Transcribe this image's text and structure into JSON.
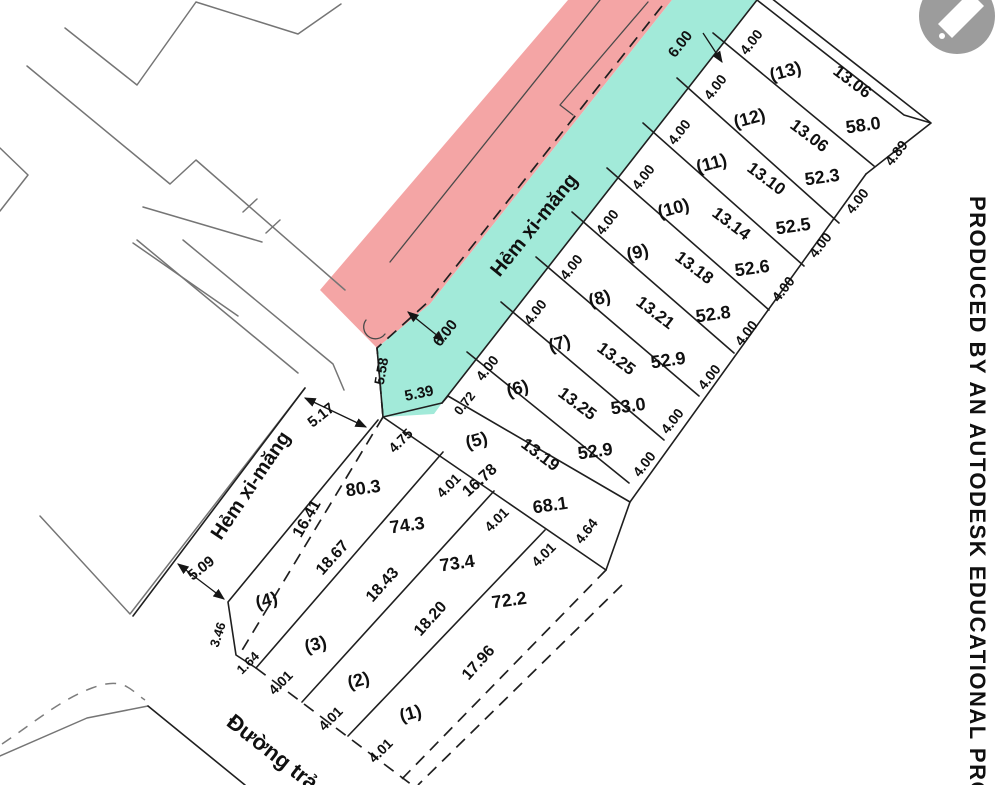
{
  "document": {
    "type": "cadastral subdivision site plan",
    "watermark_text": "PRODUCED BY AN AUTODESK EDUCATIONAL PRO",
    "overlay_icon": "pen-icon"
  },
  "colors": {
    "highlight_pink": "#f4a5a5",
    "highlight_cyan": "#a2ead9",
    "main_line": "#1f1f1f",
    "neighbor_line": "#757575",
    "watermark_circle": "#9c9c9c"
  },
  "streets": {
    "alley_upper": "Hẻm xi-măng",
    "alley_lower": "Hẻm xi-măng",
    "road_bottom": "Đường trả",
    "alley_width_top": "6.00",
    "alley_width_mid": "6.00",
    "alley_lower_widths": [
      "5.17",
      "5.09"
    ]
  },
  "plots_upper": [
    {
      "id": "(13)",
      "frontage": "4.00",
      "length": "13.06",
      "area": "58.0",
      "rear_edge": "4.89"
    },
    {
      "id": "(12)",
      "frontage": "4.00",
      "length": "13.06",
      "area": "52.3"
    },
    {
      "id": "(11)",
      "frontage": "4.00",
      "length": "13.10",
      "area": "52.5"
    },
    {
      "id": "(10)",
      "frontage": "4.00",
      "length": "13.14",
      "area": "52.6"
    },
    {
      "id": "(9)",
      "frontage": "4.00",
      "length": "13.18",
      "area": "52.8"
    },
    {
      "id": "(8)",
      "frontage": "4.00",
      "length": "13.21",
      "area": "52.9"
    },
    {
      "id": "(7)",
      "frontage": "4.00",
      "length": "13.25",
      "area": "53.0"
    },
    {
      "id": "(6)",
      "frontage": "4.00",
      "length": "13.25",
      "area": "52.9"
    },
    {
      "id": "(5)",
      "frontage": "4.00",
      "length": "13.19",
      "area": ""
    }
  ],
  "transition_strip": {
    "length": "16.78",
    "area": "68.1",
    "end_widths": [
      "4.01",
      "4.64"
    ],
    "jog": "0.72"
  },
  "plots_lower": [
    {
      "id": "(4)",
      "nw_edge": "16.41",
      "se_edge": "18.67",
      "area": "80.3",
      "top_width": "4.75",
      "west_edges": [
        "3.46",
        "1.64"
      ]
    },
    {
      "id": "(3)",
      "nw_edge": "18.67",
      "se_edge": "18.43",
      "area": "74.3",
      "top_width": "4.01",
      "road_width": "4.01"
    },
    {
      "id": "(2)",
      "nw_edge": "18.43",
      "se_edge": "18.20",
      "area": "73.4",
      "top_width": "4.01",
      "road_width": "4.01"
    },
    {
      "id": "(1)",
      "nw_edge": "18.20",
      "se_edge": "17.96",
      "area": "72.2",
      "top_width": "4.01",
      "road_width": "4.01"
    }
  ],
  "junction_dims": [
    "5.58",
    "5.39",
    "0.72",
    "5.17",
    "4.75"
  ],
  "labels": [
    {
      "t": "(13)",
      "x": 787,
      "y": 77,
      "r": -15,
      "s": 18,
      "n": "plot-number"
    },
    {
      "t": "(12)",
      "x": 751,
      "y": 124,
      "r": -15,
      "s": 18,
      "n": "plot-number"
    },
    {
      "t": "(11)",
      "x": 713,
      "y": 169,
      "r": -15,
      "s": 18,
      "n": "plot-number"
    },
    {
      "t": "(10)",
      "x": 675,
      "y": 214,
      "r": -15,
      "s": 18,
      "n": "plot-number"
    },
    {
      "t": "(9)",
      "x": 639,
      "y": 258,
      "r": -15,
      "s": 18,
      "n": "plot-number"
    },
    {
      "t": "(8)",
      "x": 601,
      "y": 304,
      "r": -15,
      "s": 18,
      "n": "plot-number"
    },
    {
      "t": "(7)",
      "x": 561,
      "y": 349,
      "r": -15,
      "s": 18,
      "n": "plot-number"
    },
    {
      "t": "(6)",
      "x": 519,
      "y": 394,
      "r": -15,
      "s": 18,
      "n": "plot-number"
    },
    {
      "t": "(5)",
      "x": 478,
      "y": 446,
      "r": -15,
      "s": 18,
      "n": "plot-number"
    },
    {
      "t": "13.06",
      "x": 849,
      "y": 86,
      "r": 37,
      "s": 17,
      "n": "plot-length"
    },
    {
      "t": "13.06",
      "x": 806,
      "y": 140,
      "r": 37,
      "s": 17,
      "n": "plot-length"
    },
    {
      "t": "13.10",
      "x": 763,
      "y": 183,
      "r": 37,
      "s": 17,
      "n": "plot-length"
    },
    {
      "t": "13.14",
      "x": 728,
      "y": 228,
      "r": 37,
      "s": 17,
      "n": "plot-length"
    },
    {
      "t": "13.18",
      "x": 691,
      "y": 272,
      "r": 37,
      "s": 17,
      "n": "plot-length"
    },
    {
      "t": "13.21",
      "x": 652,
      "y": 317,
      "r": 37,
      "s": 17,
      "n": "plot-length"
    },
    {
      "t": "13.25",
      "x": 613,
      "y": 363,
      "r": 37,
      "s": 17,
      "n": "plot-length"
    },
    {
      "t": "13.25",
      "x": 574,
      "y": 408,
      "r": 37,
      "s": 17,
      "n": "plot-length"
    },
    {
      "t": "13.19",
      "x": 537,
      "y": 459,
      "r": 37,
      "s": 17,
      "n": "plot-length"
    },
    {
      "t": "58.0",
      "x": 864,
      "y": 131,
      "r": -8,
      "s": 18,
      "n": "plot-area"
    },
    {
      "t": "52.3",
      "x": 823,
      "y": 183,
      "r": -8,
      "s": 18,
      "n": "plot-area"
    },
    {
      "t": "52.5",
      "x": 794,
      "y": 232,
      "r": -8,
      "s": 18,
      "n": "plot-area"
    },
    {
      "t": "52.6",
      "x": 753,
      "y": 274,
      "r": -8,
      "s": 18,
      "n": "plot-area"
    },
    {
      "t": "52.8",
      "x": 714,
      "y": 320,
      "r": -8,
      "s": 18,
      "n": "plot-area"
    },
    {
      "t": "52.9",
      "x": 669,
      "y": 366,
      "r": -8,
      "s": 18,
      "n": "plot-area"
    },
    {
      "t": "53.0",
      "x": 629,
      "y": 412,
      "r": -8,
      "s": 18,
      "n": "plot-area"
    },
    {
      "t": "52.9",
      "x": 596,
      "y": 457,
      "r": -8,
      "s": 18,
      "n": "plot-area"
    },
    {
      "t": "4.00",
      "x": 755,
      "y": 45,
      "r": -52,
      "s": 14,
      "n": "width-dim"
    },
    {
      "t": "4.00",
      "x": 719,
      "y": 90,
      "r": -52,
      "s": 14,
      "n": "width-dim"
    },
    {
      "t": "4.00",
      "x": 683,
      "y": 135,
      "r": -52,
      "s": 14,
      "n": "width-dim"
    },
    {
      "t": "4.00",
      "x": 647,
      "y": 180,
      "r": -52,
      "s": 14,
      "n": "width-dim"
    },
    {
      "t": "4.00",
      "x": 611,
      "y": 225,
      "r": -52,
      "s": 14,
      "n": "width-dim"
    },
    {
      "t": "4.00",
      "x": 575,
      "y": 270,
      "r": -52,
      "s": 14,
      "n": "width-dim"
    },
    {
      "t": "4.00",
      "x": 539,
      "y": 315,
      "r": -52,
      "s": 14,
      "n": "width-dim"
    },
    {
      "t": "4.00",
      "x": 491,
      "y": 371,
      "r": -52,
      "s": 14,
      "n": "width-dim"
    },
    {
      "t": "6.00",
      "x": 684,
      "y": 47,
      "r": -52,
      "s": 15,
      "n": "width-dim"
    },
    {
      "t": "0.72",
      "x": 468,
      "y": 406,
      "r": -52,
      "s": 13,
      "n": "width-dim"
    },
    {
      "t": "4.00",
      "x": 861,
      "y": 204,
      "r": -52,
      "s": 14,
      "n": "width-dim"
    },
    {
      "t": "4.00",
      "x": 824,
      "y": 248,
      "r": -52,
      "s": 14,
      "n": "width-dim"
    },
    {
      "t": "4.00",
      "x": 787,
      "y": 292,
      "r": -52,
      "s": 14,
      "n": "width-dim"
    },
    {
      "t": "4.00",
      "x": 750,
      "y": 336,
      "r": -52,
      "s": 14,
      "n": "width-dim"
    },
    {
      "t": "4.00",
      "x": 713,
      "y": 380,
      "r": -52,
      "s": 14,
      "n": "width-dim"
    },
    {
      "t": "4.00",
      "x": 676,
      "y": 424,
      "r": -52,
      "s": 14,
      "n": "width-dim"
    },
    {
      "t": "4.00",
      "x": 648,
      "y": 467,
      "r": -52,
      "s": 14,
      "n": "width-dim"
    },
    {
      "t": "4.89",
      "x": 900,
      "y": 156,
      "r": -52,
      "s": 14,
      "n": "width-dim"
    },
    {
      "t": "4.64",
      "x": 590,
      "y": 534,
      "r": -52,
      "s": 14,
      "n": "width-dim"
    },
    {
      "t": "6.00",
      "x": 449,
      "y": 336,
      "r": -52,
      "s": 15,
      "n": "width-dim"
    },
    {
      "t": "5.58",
      "x": 386,
      "y": 372,
      "r": -80,
      "s": 14,
      "n": "width-dim"
    },
    {
      "t": "5.39",
      "x": 420,
      "y": 398,
      "r": -12,
      "s": 15,
      "n": "width-dim"
    },
    {
      "t": "5.17",
      "x": 324,
      "y": 419,
      "r": -38,
      "s": 15,
      "n": "width-dim"
    },
    {
      "t": "4.75",
      "x": 404,
      "y": 444,
      "r": -45,
      "s": 14,
      "n": "width-dim"
    },
    {
      "t": "4.01",
      "x": 452,
      "y": 489,
      "r": -45,
      "s": 14,
      "n": "width-dim"
    },
    {
      "t": "4.01",
      "x": 500,
      "y": 523,
      "r": -45,
      "s": 14,
      "n": "width-dim"
    },
    {
      "t": "4.01",
      "x": 547,
      "y": 558,
      "r": -45,
      "s": 14,
      "n": "width-dim"
    },
    {
      "t": "16.78",
      "x": 483,
      "y": 484,
      "r": -42,
      "s": 16,
      "n": "plot-length"
    },
    {
      "t": "68.1",
      "x": 551,
      "y": 511,
      "r": -8,
      "s": 18,
      "n": "plot-area"
    },
    {
      "t": "(4)",
      "x": 268,
      "y": 606,
      "r": -15,
      "s": 18,
      "n": "plot-number"
    },
    {
      "t": "(3)",
      "x": 317,
      "y": 650,
      "r": -15,
      "s": 18,
      "n": "plot-number"
    },
    {
      "t": "(2)",
      "x": 360,
      "y": 686,
      "r": -15,
      "s": 18,
      "n": "plot-number"
    },
    {
      "t": "(1)",
      "x": 412,
      "y": 719,
      "r": -15,
      "s": 18,
      "n": "plot-number"
    },
    {
      "t": "16.41",
      "x": 311,
      "y": 521,
      "r": -60,
      "s": 16,
      "n": "plot-length"
    },
    {
      "t": "18.67",
      "x": 336,
      "y": 561,
      "r": -48,
      "s": 16,
      "n": "plot-length"
    },
    {
      "t": "18.43",
      "x": 386,
      "y": 588,
      "r": -48,
      "s": 16,
      "n": "plot-length"
    },
    {
      "t": "18.20",
      "x": 434,
      "y": 622,
      "r": -48,
      "s": 16,
      "n": "plot-length"
    },
    {
      "t": "17.96",
      "x": 482,
      "y": 666,
      "r": -48,
      "s": 16,
      "n": "plot-length"
    },
    {
      "t": "80.3",
      "x": 364,
      "y": 494,
      "r": -8,
      "s": 18,
      "n": "plot-area"
    },
    {
      "t": "74.3",
      "x": 408,
      "y": 531,
      "r": -8,
      "s": 18,
      "n": "plot-area"
    },
    {
      "t": "73.4",
      "x": 458,
      "y": 569,
      "r": -8,
      "s": 18,
      "n": "plot-area"
    },
    {
      "t": "72.2",
      "x": 510,
      "y": 606,
      "r": -8,
      "s": 18,
      "n": "plot-area"
    },
    {
      "t": "4.01",
      "x": 284,
      "y": 686,
      "r": -45,
      "s": 14,
      "n": "width-dim"
    },
    {
      "t": "4.01",
      "x": 334,
      "y": 722,
      "r": -45,
      "s": 14,
      "n": "width-dim"
    },
    {
      "t": "4.01",
      "x": 384,
      "y": 754,
      "r": -45,
      "s": 14,
      "n": "width-dim"
    },
    {
      "t": "1.64",
      "x": 251,
      "y": 666,
      "r": -45,
      "s": 13,
      "n": "width-dim"
    },
    {
      "t": "3.46",
      "x": 222,
      "y": 636,
      "r": -72,
      "s": 13,
      "n": "width-dim"
    },
    {
      "t": "5.09",
      "x": 204,
      "y": 572,
      "r": -38,
      "s": 15,
      "n": "width-dim"
    },
    {
      "t": "Hẻm xi-măng",
      "x": 539,
      "y": 229,
      "r": -51,
      "s": 20,
      "n": "alley-label"
    },
    {
      "t": "Hẻm xi-măng",
      "x": 256,
      "y": 489,
      "r": -56,
      "s": 20,
      "n": "alley-label"
    },
    {
      "t": "Đường trả",
      "x": 268,
      "y": 758,
      "r": 38,
      "s": 22,
      "n": "road-label"
    },
    {
      "t": "PRODUCED BY AN AUTODESK EDUCATIONAL PRO",
      "x": 970,
      "y": 196,
      "r": 90,
      "s": 22,
      "n": "watermark-text",
      "ls": 1.5
    }
  ]
}
